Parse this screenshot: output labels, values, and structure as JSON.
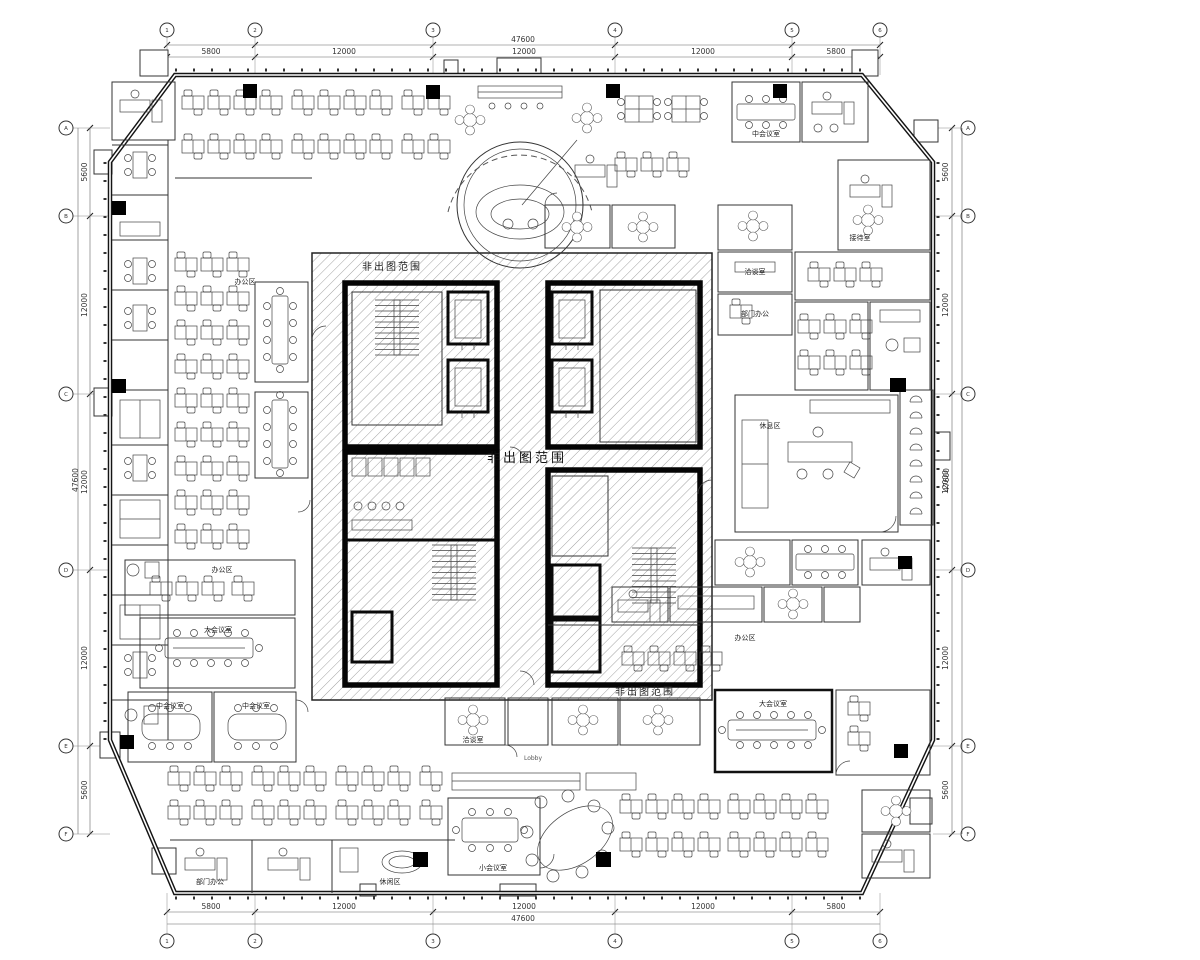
{
  "dims": {
    "top": {
      "total": "47600",
      "segments": [
        "5800",
        "12000",
        "12000",
        "12000",
        "5800"
      ]
    },
    "bottom": {
      "total": "47600",
      "segments": [
        "5800",
        "12000",
        "12000",
        "12000",
        "5800"
      ]
    },
    "left": {
      "total": "47600",
      "segments": [
        "5600",
        "12000",
        "12000",
        "12000",
        "5600"
      ]
    },
    "right": {
      "total": "47600",
      "segments": [
        "5600",
        "12000",
        "12000",
        "12000",
        "5600"
      ]
    }
  },
  "grid": {
    "top": [
      "1",
      "2",
      "3",
      "4",
      "5",
      "6"
    ],
    "bottom": [
      "1",
      "2",
      "3",
      "4",
      "5",
      "6"
    ],
    "left": [
      "A",
      "B",
      "C",
      "D",
      "E",
      "F"
    ],
    "right": [
      "A",
      "B",
      "C",
      "D",
      "E",
      "F"
    ]
  },
  "labels": {
    "core": "非出图范围",
    "lobby": "Lobby",
    "open_office": "办公区",
    "dept_office": "部门办公",
    "meeting_l": "大会议室",
    "meeting_m": "中会议室",
    "meeting_s": "小会议室",
    "talk": "洽谈室",
    "reception": "接待室",
    "lounge": "休息区",
    "leisure": "休闲区"
  }
}
